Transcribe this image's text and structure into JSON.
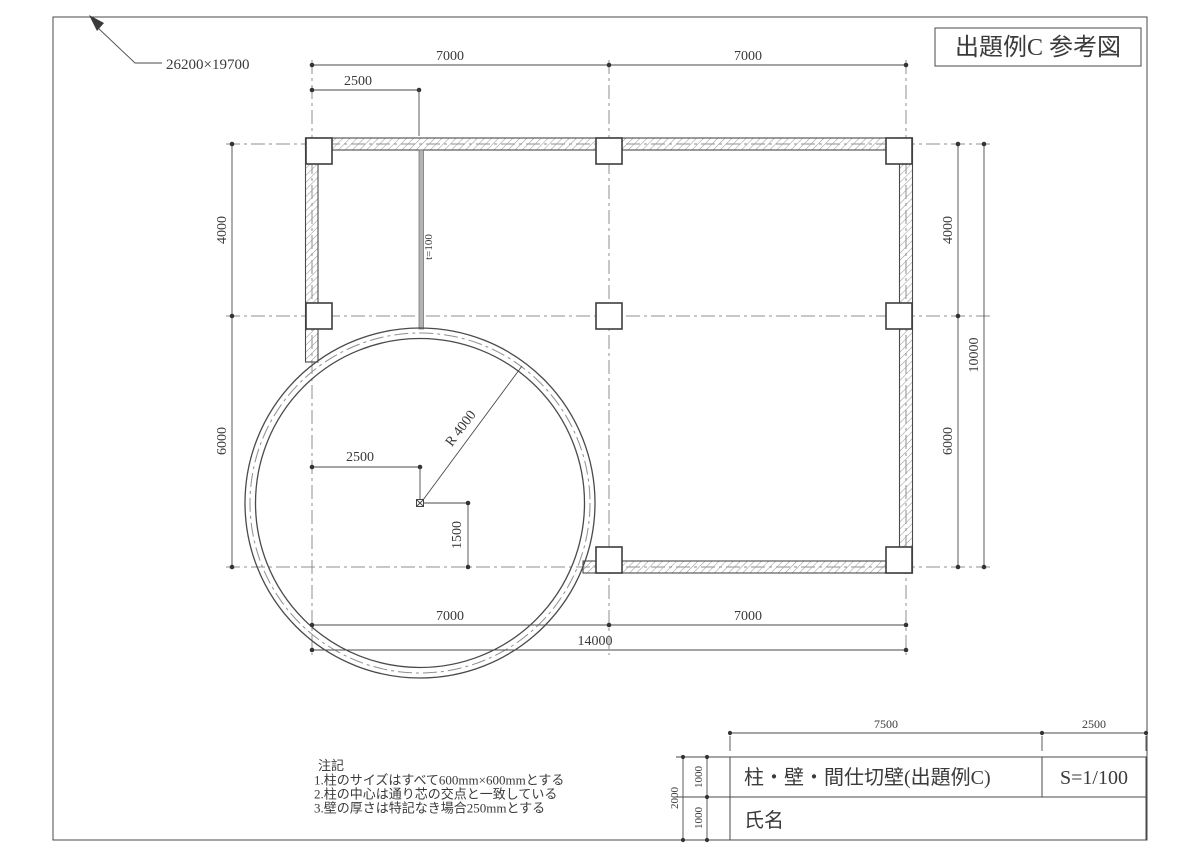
{
  "frame": {
    "sheet_size": "26200×19700"
  },
  "title_box": {
    "text": "出題例C 参考図"
  },
  "dims": {
    "top": {
      "left_span": "7000",
      "right_span": "7000",
      "partition_offset": "2500"
    },
    "left": {
      "upper": "4000",
      "lower": "6000"
    },
    "right": {
      "upper": "4000",
      "lower": "6000",
      "total": "10000"
    },
    "bottom": {
      "left_span": "7000",
      "right_span": "7000",
      "total": "14000"
    },
    "circle": {
      "center_offset_x": "2500",
      "center_offset_y": "1500",
      "radius": "R 4000"
    },
    "partition": {
      "thickness": "t=100"
    }
  },
  "notes": {
    "heading": "注記",
    "lines": [
      "1.柱のサイズはすべて600mm×600mmとする",
      "2.柱の中心は通り芯の交点と一致している",
      "3.壁の厚さは特記なき場合250mmとする"
    ]
  },
  "title_block": {
    "width_main": "7500",
    "width_scale": "2500",
    "height_total": "2000",
    "height_row1": "1000",
    "height_row2": "1000",
    "drawing_title": "柱・壁・間仕切壁(出題例C)",
    "scale": "S=1/100",
    "name_label": "氏名"
  },
  "colors": {
    "line": "#4a4a4a",
    "centerline": "#8f8f8f",
    "text": "#3a3a3a",
    "paper": "#ffffff"
  }
}
